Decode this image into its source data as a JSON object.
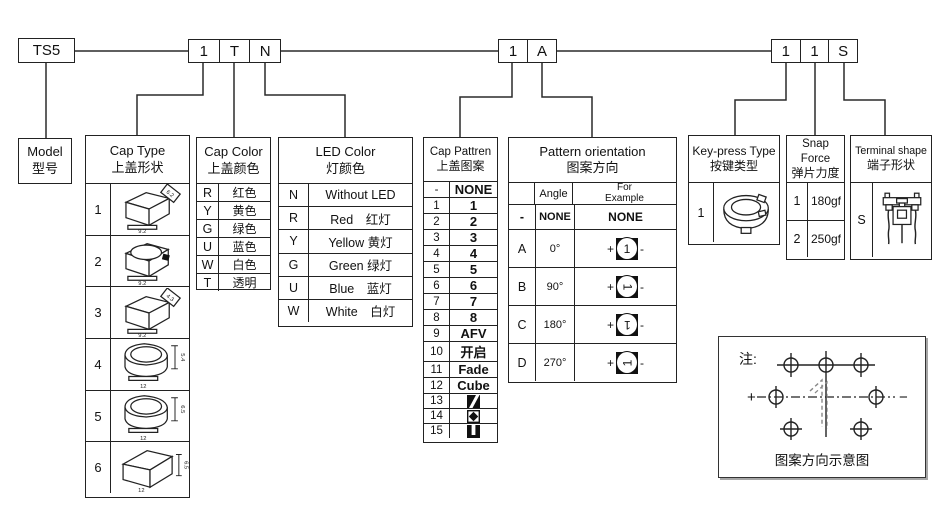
{
  "code_row": {
    "model_code": "TS5",
    "group1": [
      "1",
      "T",
      "N"
    ],
    "group2": [
      "1",
      "A"
    ],
    "group3": [
      "1",
      "1",
      "S"
    ]
  },
  "model_box": {
    "title_en": "Model",
    "title_zh": "型号"
  },
  "cap_type": {
    "title_en": "Cap Type",
    "title_zh": "上盖形状",
    "rows": [
      {
        "code": "1",
        "dim_tag": "6.2",
        "dim_base": "9.2"
      },
      {
        "code": "2",
        "dim_base": "9.2"
      },
      {
        "code": "3",
        "dim_tag": "4.3",
        "dim_base": "9.2"
      },
      {
        "code": "4",
        "dim_side": "5.4",
        "dim_base": "12"
      },
      {
        "code": "5",
        "dim_side": "6.5",
        "dim_base": "12"
      },
      {
        "code": "6",
        "dim_side": "6.5",
        "dim_base": "12"
      }
    ]
  },
  "cap_color": {
    "title_en": "Cap Color",
    "title_zh": "上盖颜色",
    "rows": [
      [
        "R",
        "红色"
      ],
      [
        "Y",
        "黄色"
      ],
      [
        "G",
        "绿色"
      ],
      [
        "U",
        "蓝色"
      ],
      [
        "W",
        "白色"
      ],
      [
        "T",
        "透明"
      ]
    ]
  },
  "led_color": {
    "title_en": "LED Color",
    "title_zh": "灯颜色",
    "rows": [
      [
        "N",
        "Without LED"
      ],
      [
        "R",
        "Red　红灯"
      ],
      [
        "Y",
        "Yellow 黄灯"
      ],
      [
        "G",
        "Green 绿灯"
      ],
      [
        "U",
        "Blue　蓝灯"
      ],
      [
        "W",
        "White　白灯"
      ]
    ]
  },
  "cap_pattern": {
    "title_en": "Cap Pattren",
    "title_zh": "上盖图案",
    "rows": [
      [
        "-",
        "NONE"
      ],
      [
        "1",
        "1"
      ],
      [
        "2",
        "2"
      ],
      [
        "3",
        "3"
      ],
      [
        "4",
        "4"
      ],
      [
        "5",
        "5"
      ],
      [
        "6",
        "6"
      ],
      [
        "7",
        "7"
      ],
      [
        "8",
        "8"
      ],
      [
        "9",
        "AFV"
      ],
      [
        "10",
        "开启"
      ],
      [
        "11",
        "Fade"
      ],
      [
        "12",
        "Cube"
      ],
      [
        "13",
        ""
      ],
      [
        "14",
        ""
      ],
      [
        "15",
        ""
      ]
    ],
    "icons": {
      "13": "diagonal-stripe",
      "14": "diamond",
      "15": "vertical-bar"
    }
  },
  "pattern_orientation": {
    "title_en": "Pattern orientation",
    "title_zh": "图案方向",
    "col_angle": "Angle",
    "col_example_1": "For",
    "col_example_2": "Example",
    "none_row": {
      "code": "-",
      "angle": "NONE",
      "example": "NONE"
    },
    "rows": [
      {
        "code": "A",
        "angle": "0°"
      },
      {
        "code": "B",
        "angle": "90°"
      },
      {
        "code": "C",
        "angle": "180°"
      },
      {
        "code": "D",
        "angle": "270°"
      }
    ],
    "example_digit": "1",
    "plus": "+",
    "minus": "-"
  },
  "key_press": {
    "title_en": "Key-press Type",
    "title_zh": "按键类型",
    "code": "1"
  },
  "snap_force": {
    "title_en": "Snap Force",
    "title_zh": "弹片力度",
    "rows": [
      [
        "1",
        "180gf"
      ],
      [
        "2",
        "250gf"
      ]
    ]
  },
  "terminal_shape": {
    "title_en": "Terminal shape",
    "title_zh": "端子形状",
    "code": "S"
  },
  "note_box": {
    "label": "注:",
    "plus": "+",
    "minus": "−",
    "digit": "1",
    "caption": "图案方向示意图"
  }
}
